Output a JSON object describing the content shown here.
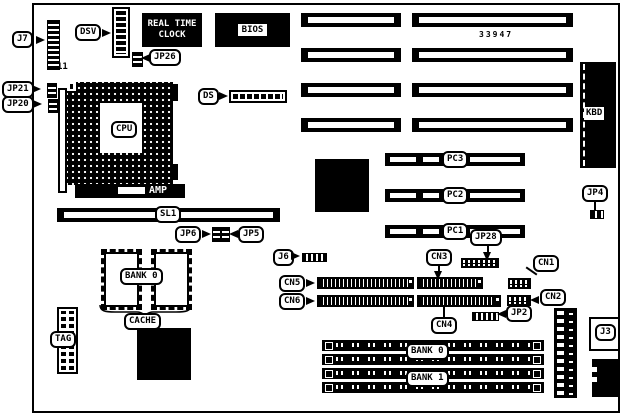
{
  "diagram": {
    "kind": "motherboard-layout"
  },
  "colors": {
    "ink": "#000000",
    "paper": "#ffffff"
  },
  "labels": {
    "j7": "J7",
    "pin11": "11",
    "dsv": "DSV",
    "rtc_line1": "REAL TIME",
    "rtc_line2": "CLOCK",
    "bios": "BIOS",
    "jp26": "JP26",
    "jp21": "JP21",
    "jp20": "JP20",
    "cpu": "CPU",
    "amp": "AMP",
    "ds": "DS",
    "part_number": "33947",
    "kbd": "KBD",
    "jp4": "JP4",
    "pc3": "PC3",
    "pc2": "PC2",
    "pc1": "PC1",
    "jp28": "JP28",
    "sl1": "SL1",
    "jp6": "JP6",
    "jp5": "JP5",
    "bank0_cache": "BANK 0",
    "cache": "CACHE",
    "tag": "TAG",
    "j6": "J6",
    "cn5": "CN5",
    "cn6": "CN6",
    "cn3": "CN3",
    "cn4": "CN4",
    "cn1": "CN1",
    "cn2": "CN2",
    "jp2": "JP2",
    "bank0_simm": "BANK 0",
    "bank1_simm": "BANK 1",
    "j3": "J3"
  }
}
